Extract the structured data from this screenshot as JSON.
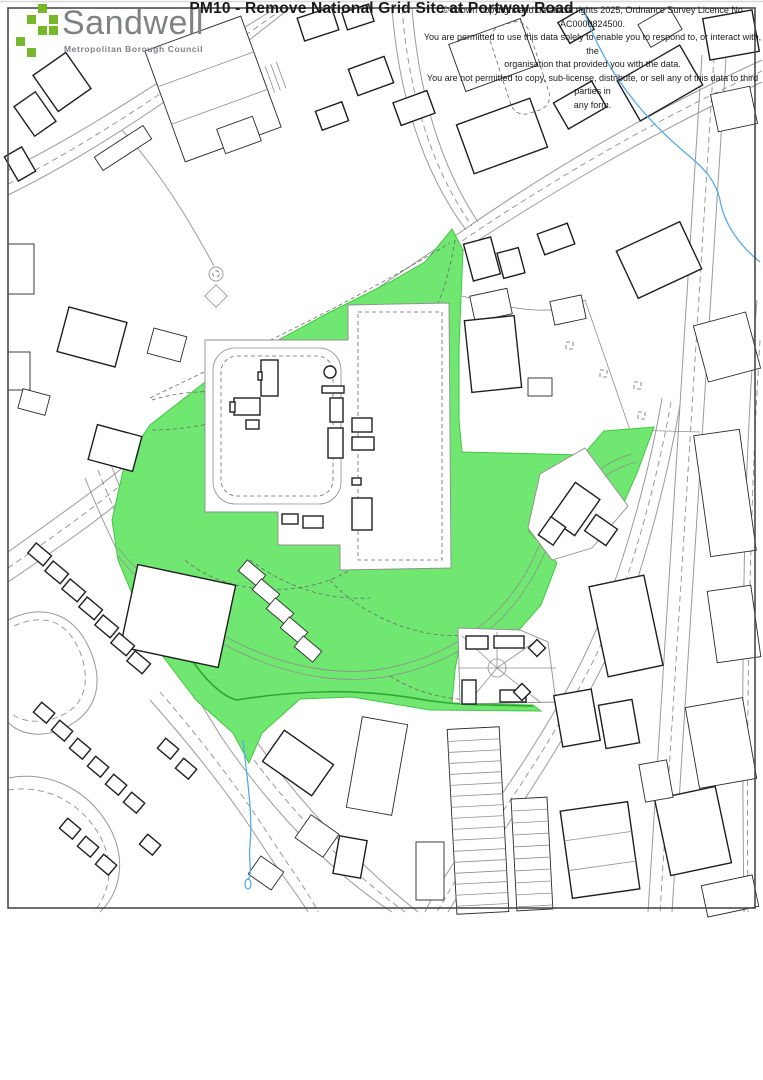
{
  "title": {
    "text": "PM10 - Remove National Grid Site at Portway Road"
  },
  "map": {
    "site_fill_color": "#70e770",
    "site_outline_color": "#3cbc3c",
    "water_color": "#58abe8",
    "building_outline_color": "#1f1f1f",
    "road_color": "#9a9a9a",
    "frame_color": "#4a4a4a"
  },
  "footer": {
    "logo": {
      "name": "Sandwell",
      "subtitle": "Metropolitan Borough Council",
      "squares_color": "#76b82a",
      "text_color": "#7f8184"
    },
    "copyright_lines": [
      "© Crown copyright and database rights 2025, Ordnance Survey Licence No AC0000824500.",
      "You are permitted to use this data solely to enable you to respond to, or interact with, the",
      "organisation that provided you with the data.",
      "You are not permitted to copy, sub-license, distribute, or sell any of this data to third parties in",
      "any form."
    ]
  }
}
